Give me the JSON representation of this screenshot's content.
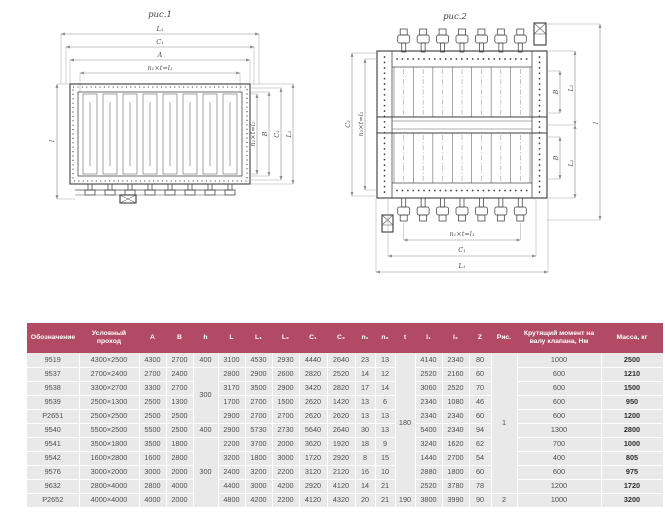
{
  "colors": {
    "header_bg": "#b34a63",
    "row_bg": "#e9e9e9"
  },
  "figures": {
    "fig1": {
      "title": "рис.1",
      "dims_top": [
        "L₁",
        "C₁",
        "A",
        "n₁×t=l₁"
      ],
      "dims_right": [
        "n₂×t=l₂",
        "B",
        "C₂",
        "L₂"
      ],
      "dim_left": "l"
    },
    "fig2": {
      "title": "рис.2",
      "dims_bottom": [
        "n₁×t=l₁",
        "C₁",
        "L₁"
      ],
      "dims_right": [
        "B",
        "L₂",
        "B",
        "L₂",
        "l"
      ],
      "dims_left": [
        "C₂",
        "n₂×t=l₂"
      ]
    }
  },
  "table": {
    "headers": [
      "Обозначение",
      "Условный проход",
      "A",
      "B",
      "h",
      "L",
      "L₁",
      "L₂",
      "C₁",
      "C₂",
      "n₁",
      "n₂",
      "t",
      "l₁",
      "l₂",
      "Z",
      "Рис.",
      "Крутящий момент на валу клапана, Нм",
      "Масса, кг"
    ],
    "rows": [
      [
        "9519",
        "4300×2500",
        "4300",
        "2700",
        {
          "v": "400"
        },
        "3100",
        "4530",
        "2930",
        "4440",
        "2640",
        "23",
        "13",
        {
          "v": "180",
          "rs": 10
        },
        "4140",
        "2340",
        "80",
        {
          "v": "1",
          "rs": 10
        },
        "1000",
        "2500"
      ],
      [
        "9537",
        "2700×2400",
        "2700",
        "2400",
        {
          "v": "300",
          "rs": 4
        },
        "2800",
        "2900",
        "2600",
        "2820",
        "2520",
        "14",
        "12",
        null,
        "2520",
        "2160",
        "60",
        null,
        "600",
        "1210"
      ],
      [
        "9538",
        "3300×2700",
        "3300",
        "2700",
        null,
        "3170",
        "3500",
        "2900",
        "3420",
        "2820",
        "17",
        "14",
        null,
        "3060",
        "2520",
        "70",
        null,
        "600",
        "1500"
      ],
      [
        "9539",
        "2500×1300",
        "2500",
        "1300",
        null,
        "1700",
        "2700",
        "1500",
        "2620",
        "1420",
        "13",
        "6",
        null,
        "2340",
        "1080",
        "46",
        null,
        "600",
        "950"
      ],
      [
        "Р2651",
        "2500×2500",
        "2500",
        "2500",
        null,
        "2900",
        "2700",
        "2700",
        "2620",
        "2620",
        "13",
        "13",
        null,
        "2340",
        "2340",
        "60",
        null,
        "600",
        "1200"
      ],
      [
        "9540",
        "5500×2500",
        "5500",
        "2500",
        {
          "v": "400"
        },
        "2900",
        "5730",
        "2730",
        "5640",
        "2640",
        "30",
        "13",
        null,
        "5400",
        "2340",
        "94",
        null,
        "1300",
        "2800"
      ],
      [
        "9541",
        "3500×1800",
        "3500",
        "1800",
        {
          "v": "300",
          "rs": 5
        },
        "2200",
        "3700",
        "2000",
        "3620",
        "1920",
        "18",
        "9",
        null,
        "3240",
        "1620",
        "62",
        null,
        "700",
        "1000"
      ],
      [
        "9542",
        "1600×2800",
        "1600",
        "2800",
        null,
        "3200",
        "1800",
        "3000",
        "1720",
        "2920",
        "8",
        "15",
        null,
        "1440",
        "2700",
        "54",
        null,
        "400",
        "805"
      ],
      [
        "9576",
        "3000×2000",
        "3000",
        "2000",
        null,
        "2400",
        "3200",
        "2200",
        "3120",
        "2120",
        "16",
        "10",
        null,
        "2880",
        "1800",
        "60",
        null,
        "600",
        "975"
      ],
      [
        "9632",
        "2800×4000",
        "2800",
        "4000",
        null,
        "4400",
        "3000",
        "4200",
        "2920",
        "4120",
        "14",
        "21",
        null,
        "2520",
        "3780",
        "78",
        null,
        "1200",
        "1720"
      ],
      [
        "Р2652",
        "4000×4000",
        "4000",
        "2000",
        null,
        "4800",
        "4200",
        "2200",
        "4120",
        "4320",
        "20",
        "21",
        "190",
        "3800",
        "3990",
        "90",
        "2",
        "1000",
        "3200"
      ]
    ]
  }
}
